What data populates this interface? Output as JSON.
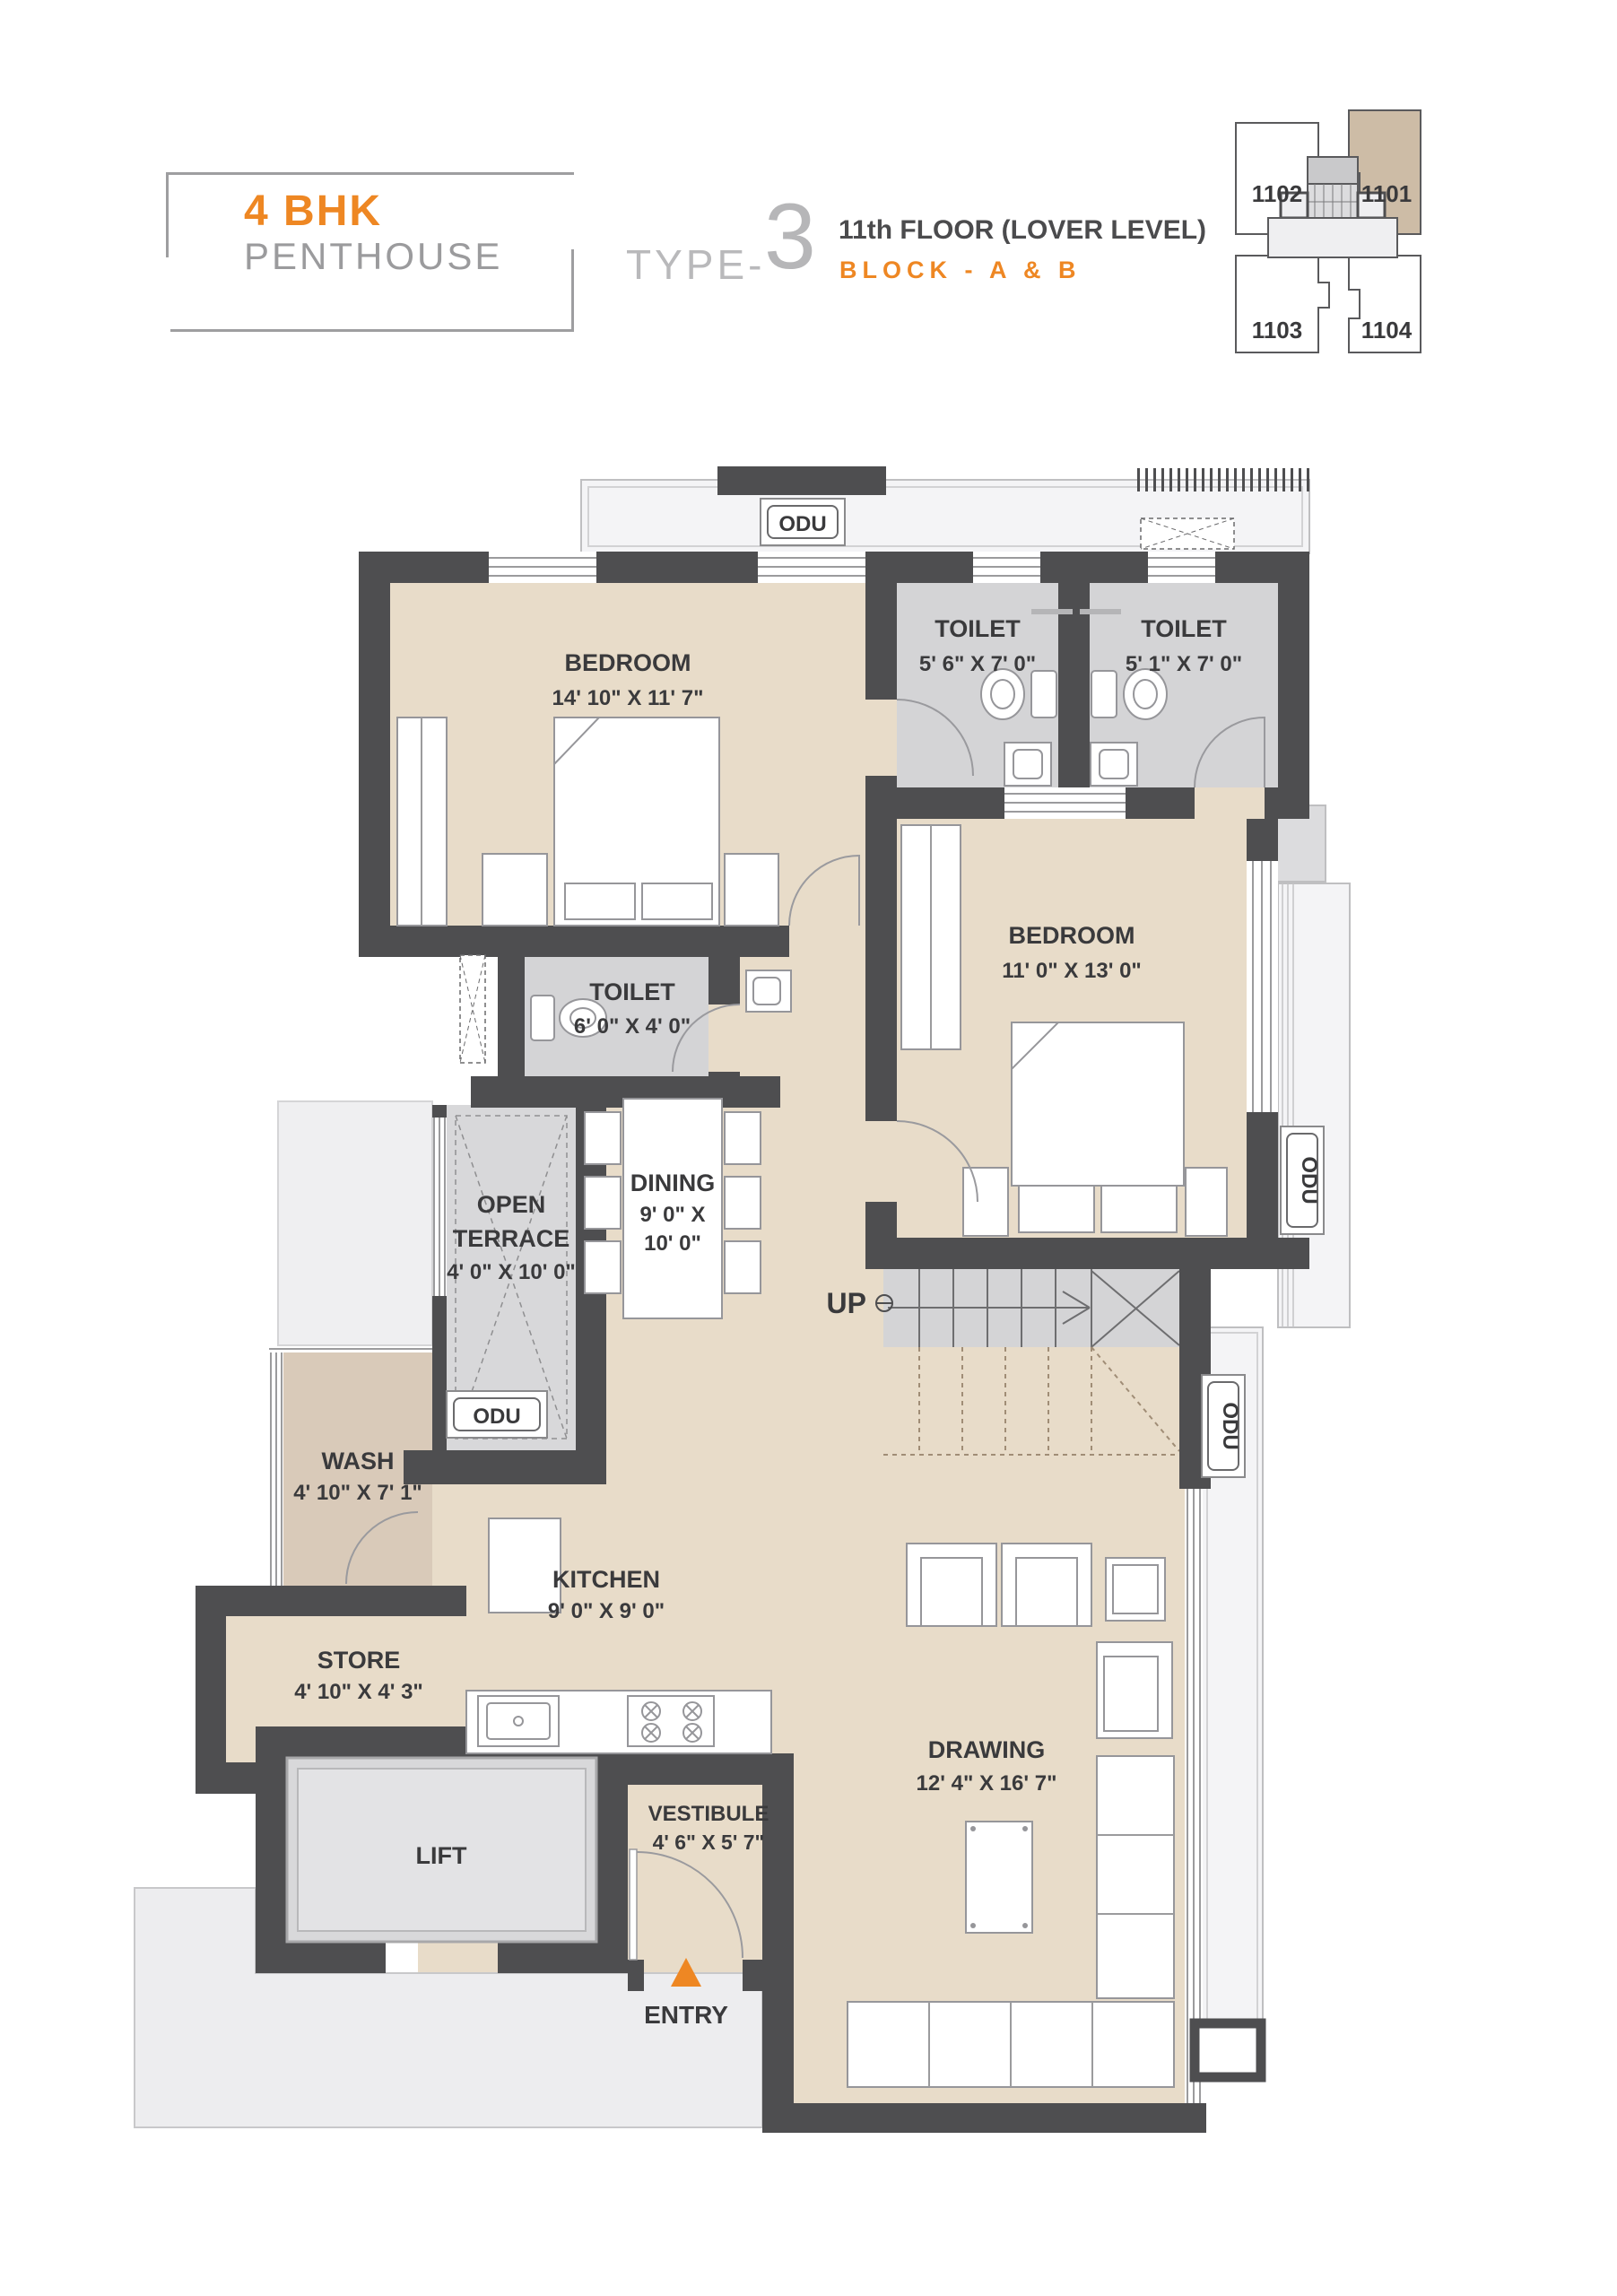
{
  "header": {
    "unit_type": "4 BHK",
    "unit_subtype": "PENTHOUSE",
    "type_label": "TYPE-",
    "type_number": "3",
    "floor_info": "11th FLOOR (LOVER LEVEL)",
    "block_info": "BLOCK - A & B"
  },
  "key_plan": {
    "units": [
      {
        "id": "1102",
        "highlighted": false
      },
      {
        "id": "1101",
        "highlighted": true
      },
      {
        "id": "1103",
        "highlighted": false
      },
      {
        "id": "1104",
        "highlighted": false
      }
    ],
    "highlight_color": "#cdbca6"
  },
  "rooms": {
    "bedroom1": {
      "name": "BEDROOM",
      "dims": "14' 10\" X 11' 7\""
    },
    "toilet1": {
      "name": "TOILET",
      "dims": "5' 6\" X 7' 0\""
    },
    "toilet2": {
      "name": "TOILET",
      "dims": "5' 1\" X 7' 0\""
    },
    "bedroom2": {
      "name": "BEDROOM",
      "dims": "11' 0\" X 13' 0\""
    },
    "toilet3": {
      "name": "TOILET",
      "dims": "6' 0\" X 4' 0\""
    },
    "terrace": {
      "name_lines": [
        "OPEN",
        "TERRACE"
      ],
      "dims": "4' 0\" X 10' 0\""
    },
    "dining": {
      "name": "DINING",
      "dims_lines": [
        "9' 0\" X",
        "10' 0\""
      ]
    },
    "wash": {
      "name": "WASH",
      "dims": "4' 10\" X 7' 1\""
    },
    "kitchen": {
      "name": "KITCHEN",
      "dims": "9' 0\" X 9' 0\""
    },
    "store": {
      "name": "STORE",
      "dims": "4' 10\" X 4' 3\""
    },
    "drawing": {
      "name": "DRAWING",
      "dims": "12' 4\" X 16' 7\""
    },
    "vestibule": {
      "name": "VESTIBULE",
      "dims": "4' 6\" X 5' 7\""
    },
    "lift": {
      "name": "LIFT"
    }
  },
  "labels": {
    "odu": "ODU",
    "up": "UP",
    "entry": "ENTRY"
  },
  "colors": {
    "accent_orange": "#ee8723",
    "wall_gray": "#4e4e50",
    "floor_beige": "#e8dcc9",
    "floor_gray": "#d4d4d6",
    "wash_tan": "#d9cab9",
    "keyplan_highlight": "#cdbca6"
  }
}
